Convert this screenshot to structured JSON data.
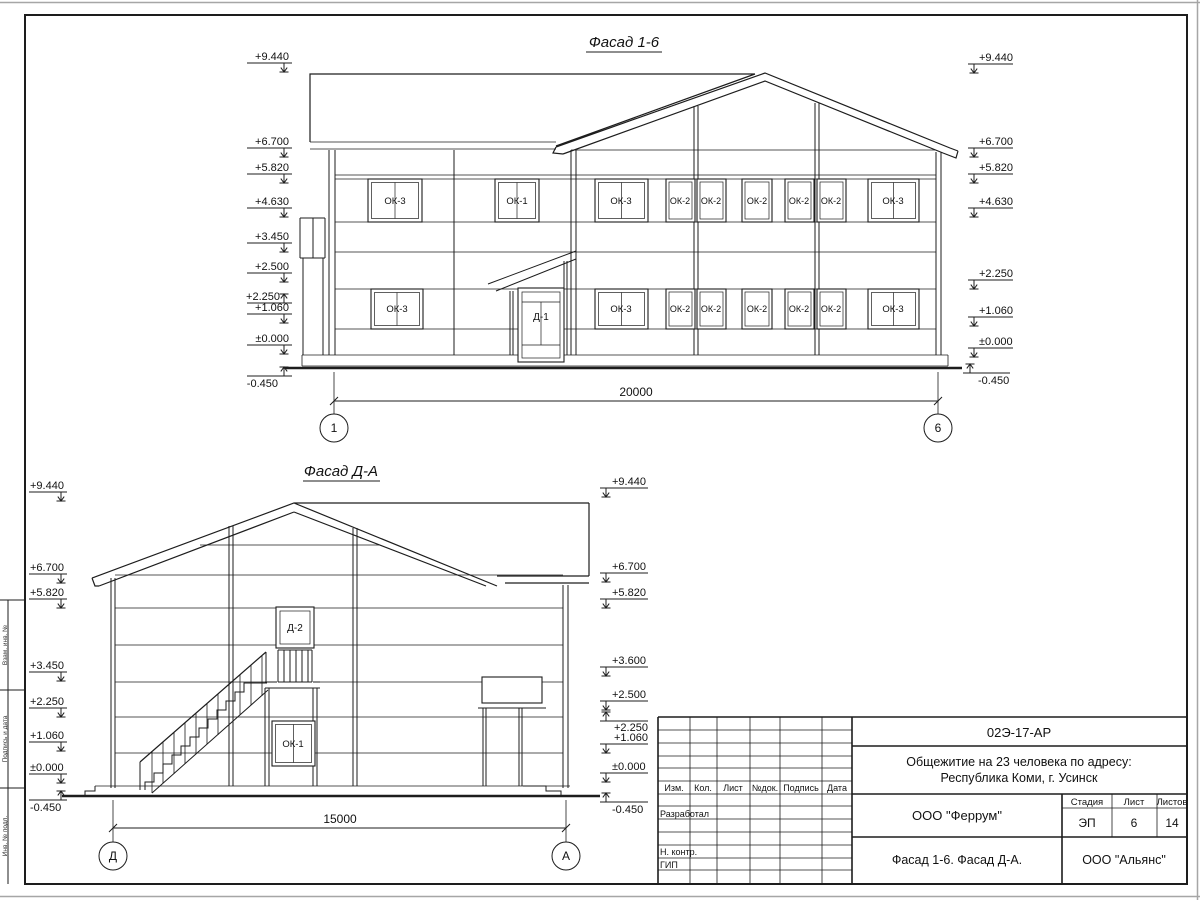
{
  "sheet": {
    "frame_side_labels": [
      "Взам. инв. №",
      "Подпись и дата",
      "Инв. № подл."
    ]
  },
  "fasad16": {
    "title": "Фасад 1-6",
    "marks_left": [
      "+9.440",
      "+6.700",
      "+5.820",
      "+4.630",
      "+3.450",
      "+2.500",
      "+2.250",
      "+1.060",
      "±0.000",
      "-0.450"
    ],
    "marks_right": [
      "+9.440",
      "+6.700",
      "+5.820",
      "+4.630",
      "+2.250",
      "+1.060",
      "±0.000",
      "-0.450"
    ],
    "windows_upper": [
      "ОК-3",
      "ОК-1",
      "ОК-3",
      "ОК-2",
      "ОК-2",
      "ОК-2",
      "ОК-2",
      "ОК-2",
      "ОК-3"
    ],
    "windows_lower": [
      "ОК-3",
      "ОК-3",
      "ОК-2",
      "ОК-2",
      "ОК-2",
      "ОК-2",
      "ОК-2",
      "ОК-3"
    ],
    "door": "Д-1",
    "dim": "20000",
    "axis_left": "1",
    "axis_right": "6"
  },
  "fasadDA": {
    "title": "Фасад Д-А",
    "marks_left": [
      "+9.440",
      "+6.700",
      "+5.820",
      "+3.450",
      "+2.250",
      "+1.060",
      "±0.000",
      "-0.450"
    ],
    "marks_right": [
      "+9.440",
      "+6.700",
      "+5.820",
      "+3.600",
      "+2.500",
      "+2.250",
      "+1.060",
      "±0.000",
      "-0.450"
    ],
    "door": "Д-2",
    "window": "ОК-1",
    "dim": "15000",
    "axis_left": "Д",
    "axis_right": "А"
  },
  "titleblock": {
    "doc_number": "02Э-17-АР",
    "project_line1": "Общежитие на 23 человека по адресу:",
    "project_line2": "Республика Коми, г. Усинск",
    "col_headers": [
      "Изм.",
      "Кол.",
      "Лист",
      "№док.",
      "Подпись",
      "Дата"
    ],
    "roles": [
      "Разработал",
      "Н. контр.",
      "ГИП"
    ],
    "designer_org": "ООО \"Феррум\"",
    "stage_label": "Стадия",
    "stage": "ЭП",
    "sheet_label": "Лист",
    "sheet_number": "6",
    "sheets_label": "Листов",
    "sheets_total": "14",
    "sheet_title": "Фасад 1-6. Фасад Д-А.",
    "client_org": "ООО \"Альянс\""
  }
}
